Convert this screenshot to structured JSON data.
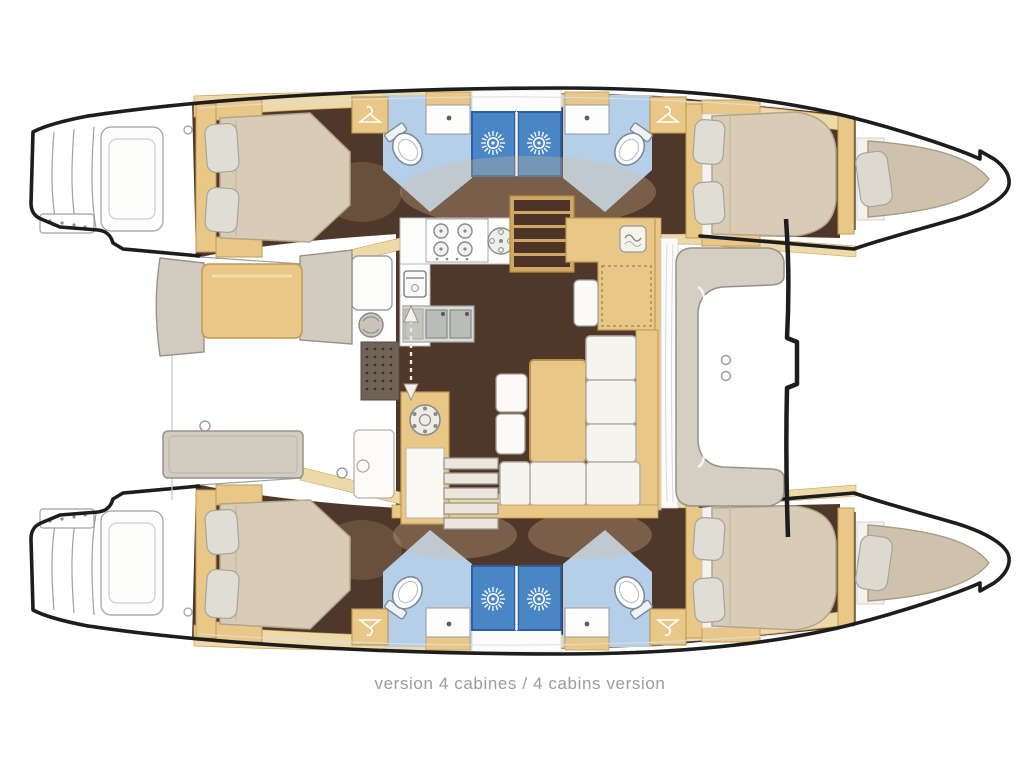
{
  "diagram": {
    "caption": "version 4 cabines / 4 cabins version",
    "caption_fr": "version 4 cabines",
    "caption_en": "4 cabins version",
    "subject": "catamaran interior floor plan, 4-cabin layout, two hulls with mirrored cabins and bathrooms, central saloon with galley and nav station"
  },
  "icons": [
    "shower-head-icon",
    "coat-hanger-icon",
    "toilet-icon",
    "sink-icon",
    "double-sink-icon",
    "stove-burners-icon",
    "hotplate-icon",
    "oven-icon",
    "washer-icon",
    "stairs-icon",
    "arrow-door-icon",
    "deck-fitting-icon"
  ],
  "colors": {
    "hull_outline": "#1d1d1d",
    "wood_cabinet": "#e9c887",
    "wood_deck": "#eed9a8",
    "wood_trim": "#bf9a55",
    "floor_dark_brown": "#4f3729",
    "bed_beige": "#d8ccb6",
    "bathroom_floor_blue": "#b5cfe9",
    "shower_blue": "#4a86c6",
    "furniture_gray": "#d4cdc2",
    "outline_gray": "#9aa0a6",
    "caption_gray": "#9b9b9b"
  }
}
